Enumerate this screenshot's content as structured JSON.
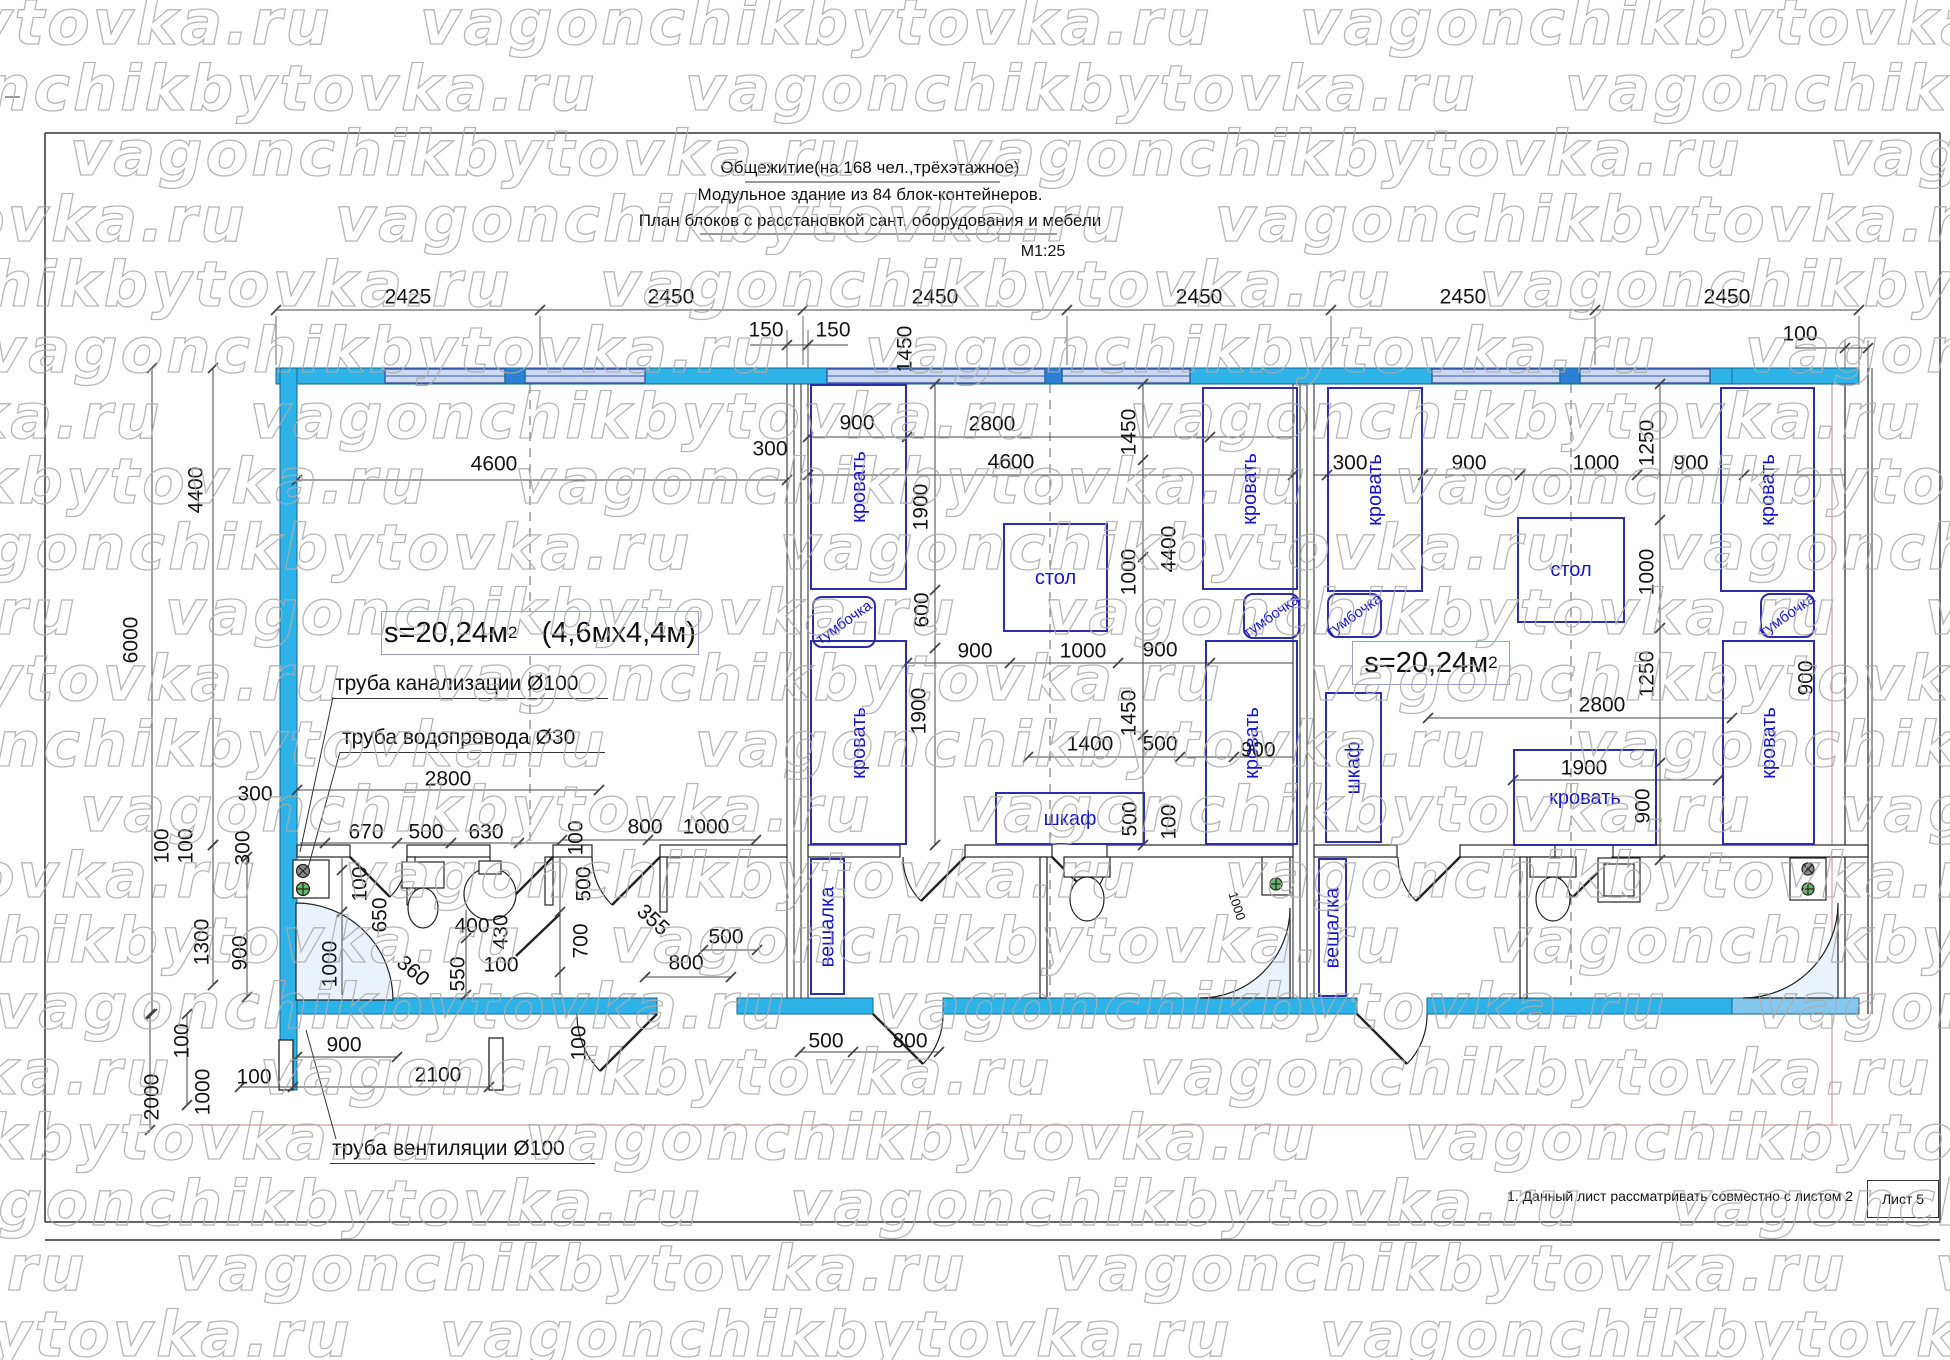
{
  "watermark": {
    "text": "vagonchikbytovka.ru",
    "color": "#ababab"
  },
  "title": {
    "line1": "Общежитие(на 168 чел.,трёхэтажное)",
    "line2": "Модульное  здание из 84 блок-контейнеров.",
    "line3": "План блоков с расстановкой сант. оборудования и мебели",
    "scale": "М1:25"
  },
  "areas": {
    "left_value": "s=20,24м",
    "left_sup": "2",
    "left_size": "(4,6мх4,4м)",
    "right_value": "s=20,24м",
    "right_sup": "2"
  },
  "pipes": {
    "sewer": "труба канализации Ø100",
    "water": "труба водопровода  Ø30",
    "vent": "труба вентиляции  Ø100"
  },
  "footer": {
    "note": "1. Данный лист рассматривать совместно с листом 2",
    "sheet": "Лист 5"
  },
  "colors": {
    "wall": "#2eb3e8",
    "wall_dark": "#2b7fd4",
    "window": "#ccd9f2",
    "window_border": "#3b55a8",
    "wall_light": "#85c8ef",
    "furniture": "#2d2da8",
    "furniture_text": "#1414cc",
    "axis_red": "#cf9f9f",
    "shower": "#eaf3fb"
  },
  "dims": [
    {
      "t": "2425",
      "x": 408,
      "y": 297
    },
    {
      "t": "2450",
      "x": 671,
      "y": 297
    },
    {
      "t": "2450",
      "x": 935,
      "y": 297
    },
    {
      "t": "2450",
      "x": 1199,
      "y": 297
    },
    {
      "t": "2450",
      "x": 1463,
      "y": 297
    },
    {
      "t": "2450",
      "x": 1727,
      "y": 297
    },
    {
      "t": "150",
      "x": 766,
      "y": 330
    },
    {
      "t": "150",
      "x": 833,
      "y": 330
    },
    {
      "t": "100",
      "x": 1800,
      "y": 334
    },
    {
      "t": "6000",
      "x": 131,
      "y": 640,
      "r": -90
    },
    {
      "t": "4400",
      "x": 196,
      "y": 490,
      "r": -90
    },
    {
      "t": "4600",
      "x": 494,
      "y": 464
    },
    {
      "t": "4600",
      "x": 1011,
      "y": 462
    },
    {
      "t": "300",
      "x": 770,
      "y": 449
    },
    {
      "t": "900",
      "x": 857,
      "y": 423
    },
    {
      "t": "2800",
      "x": 992,
      "y": 424
    },
    {
      "t": "1450",
      "x": 905,
      "y": 349,
      "r": -90
    },
    {
      "t": "1900",
      "x": 921,
      "y": 507,
      "r": -90
    },
    {
      "t": "600",
      "x": 922,
      "y": 610,
      "r": -90
    },
    {
      "t": "1900",
      "x": 919,
      "y": 711,
      "r": -90
    },
    {
      "t": "900",
      "x": 975,
      "y": 651
    },
    {
      "t": "1000",
      "x": 1083,
      "y": 651
    },
    {
      "t": "900",
      "x": 1160,
      "y": 650
    },
    {
      "t": "4400",
      "x": 1169,
      "y": 549,
      "r": -90
    },
    {
      "t": "1450",
      "x": 1129,
      "y": 432,
      "r": -90
    },
    {
      "t": "1000",
      "x": 1129,
      "y": 572,
      "r": -90
    },
    {
      "t": "1450",
      "x": 1129,
      "y": 713,
      "r": -90
    },
    {
      "t": "1400",
      "x": 1090,
      "y": 744
    },
    {
      "t": "500",
      "x": 1160,
      "y": 744
    },
    {
      "t": "500",
      "x": 1130,
      "y": 819,
      "r": -90
    },
    {
      "t": "100",
      "x": 1169,
      "y": 822,
      "r": -90
    },
    {
      "t": "900",
      "x": 1258,
      "y": 750
    },
    {
      "t": "1000",
      "x": 1237,
      "y": 906,
      "r": 72,
      "s": 1
    },
    {
      "t": "300",
      "x": 1350,
      "y": 463
    },
    {
      "t": "900",
      "x": 1469,
      "y": 463
    },
    {
      "t": "1000",
      "x": 1596,
      "y": 463
    },
    {
      "t": "900",
      "x": 1691,
      "y": 463
    },
    {
      "t": "1250",
      "x": 1647,
      "y": 443,
      "r": -90
    },
    {
      "t": "1000",
      "x": 1647,
      "y": 572,
      "r": -90
    },
    {
      "t": "1250",
      "x": 1647,
      "y": 674,
      "r": -90
    },
    {
      "t": "2800",
      "x": 1602,
      "y": 705
    },
    {
      "t": "1900",
      "x": 1584,
      "y": 768
    },
    {
      "t": "900",
      "x": 1643,
      "y": 806,
      "r": -90
    },
    {
      "t": "900",
      "x": 1806,
      "y": 678,
      "r": -90
    },
    {
      "t": "2800",
      "x": 448,
      "y": 779
    },
    {
      "t": "300",
      "x": 255,
      "y": 794
    },
    {
      "t": "670",
      "x": 366,
      "y": 832
    },
    {
      "t": "500",
      "x": 426,
      "y": 832
    },
    {
      "t": "630",
      "x": 486,
      "y": 832
    },
    {
      "t": "100",
      "x": 576,
      "y": 838,
      "r": -90
    },
    {
      "t": "800",
      "x": 645,
      "y": 827
    },
    {
      "t": "1000",
      "x": 706,
      "y": 827
    },
    {
      "t": "100",
      "x": 162,
      "y": 846,
      "r": -90
    },
    {
      "t": "100",
      "x": 186,
      "y": 846,
      "r": -90
    },
    {
      "t": "300",
      "x": 243,
      "y": 848,
      "r": -90
    },
    {
      "t": "1300",
      "x": 202,
      "y": 942,
      "r": -90
    },
    {
      "t": "900",
      "x": 240,
      "y": 953,
      "r": -90
    },
    {
      "t": "100",
      "x": 360,
      "y": 884,
      "r": -90
    },
    {
      "t": "650",
      "x": 380,
      "y": 915,
      "r": -90
    },
    {
      "t": "1000",
      "x": 330,
      "y": 964,
      "r": -90
    },
    {
      "t": "400",
      "x": 472,
      "y": 926
    },
    {
      "t": "430",
      "x": 501,
      "y": 932,
      "r": -90
    },
    {
      "t": "360",
      "x": 413,
      "y": 971,
      "r": 40
    },
    {
      "t": "550",
      "x": 458,
      "y": 974,
      "r": -90
    },
    {
      "t": "100",
      "x": 501,
      "y": 965
    },
    {
      "t": "500",
      "x": 584,
      "y": 884,
      "r": -90
    },
    {
      "t": "700",
      "x": 581,
      "y": 941,
      "r": -90
    },
    {
      "t": "355",
      "x": 653,
      "y": 920,
      "r": 42
    },
    {
      "t": "500",
      "x": 726,
      "y": 937
    },
    {
      "t": "800",
      "x": 686,
      "y": 963
    },
    {
      "t": "100",
      "x": 579,
      "y": 1043,
      "r": -90
    },
    {
      "t": "900",
      "x": 344,
      "y": 1045
    },
    {
      "t": "100",
      "x": 254,
      "y": 1077
    },
    {
      "t": "2100",
      "x": 438,
      "y": 1075
    },
    {
      "t": "500",
      "x": 826,
      "y": 1041
    },
    {
      "t": "800",
      "x": 910,
      "y": 1041
    },
    {
      "t": "100",
      "x": 182,
      "y": 1041,
      "r": -90
    },
    {
      "t": "1000",
      "x": 203,
      "y": 1092,
      "r": -90
    },
    {
      "t": "2000",
      "x": 152,
      "y": 1097,
      "r": -90
    }
  ],
  "furniture": [
    {
      "kind": "bed",
      "label": "кровать",
      "x": 810,
      "y": 384,
      "w": 97,
      "h": 206,
      "lab": "v"
    },
    {
      "kind": "bed",
      "label": "кровать",
      "x": 810,
      "y": 640,
      "w": 97,
      "h": 205,
      "lab": "v"
    },
    {
      "kind": "bed",
      "label": "кровать",
      "x": 1202,
      "y": 387,
      "w": 96,
      "h": 203,
      "lab": "v"
    },
    {
      "kind": "bed",
      "label": "кровать",
      "x": 1205,
      "y": 640,
      "w": 93,
      "h": 205,
      "lab": "v"
    },
    {
      "kind": "bed",
      "label": "кровать",
      "x": 1327,
      "y": 387,
      "w": 96,
      "h": 205,
      "lab": "v"
    },
    {
      "kind": "bed",
      "label": "кровать",
      "x": 1720,
      "y": 387,
      "w": 95,
      "h": 205,
      "lab": "v"
    },
    {
      "kind": "bed",
      "label": "кровать",
      "x": 1722,
      "y": 640,
      "w": 93,
      "h": 205,
      "lab": "v"
    },
    {
      "kind": "bed",
      "label": "кровать",
      "x": 1513,
      "y": 749,
      "w": 144,
      "h": 97,
      "lab": "h"
    },
    {
      "kind": "nightstand",
      "label": "тумбочка",
      "x": 812,
      "y": 596,
      "w": 64,
      "h": 52,
      "lab": "t",
      "rounded": 1
    },
    {
      "kind": "nightstand",
      "label": "тумбочка",
      "x": 1243,
      "y": 593,
      "w": 57,
      "h": 46,
      "lab": "t",
      "rounded": 1
    },
    {
      "kind": "nightstand",
      "label": "тумбочка",
      "x": 1327,
      "y": 593,
      "w": 55,
      "h": 45,
      "lab": "t",
      "rounded": 1
    },
    {
      "kind": "nightstand",
      "label": "тумбочка",
      "x": 1760,
      "y": 593,
      "w": 55,
      "h": 45,
      "lab": "t",
      "rounded": 1
    },
    {
      "kind": "table",
      "label": "стол",
      "x": 1003,
      "y": 523,
      "w": 105,
      "h": 109,
      "lab": "h"
    },
    {
      "kind": "table",
      "label": "стол",
      "x": 1517,
      "y": 517,
      "w": 108,
      "h": 106,
      "lab": "h"
    },
    {
      "kind": "wardrobe",
      "label": "шкаф",
      "x": 995,
      "y": 792,
      "w": 150,
      "h": 53,
      "lab": "h"
    },
    {
      "kind": "wardrobe",
      "label": "шкаф",
      "x": 1325,
      "y": 692,
      "w": 57,
      "h": 151,
      "lab": "v"
    },
    {
      "kind": "hanger",
      "label": "вешалка",
      "x": 810,
      "y": 858,
      "w": 35,
      "h": 137,
      "lab": "v"
    },
    {
      "kind": "hanger",
      "label": "вешалка",
      "x": 1318,
      "y": 858,
      "w": 29,
      "h": 139,
      "lab": "v"
    }
  ]
}
